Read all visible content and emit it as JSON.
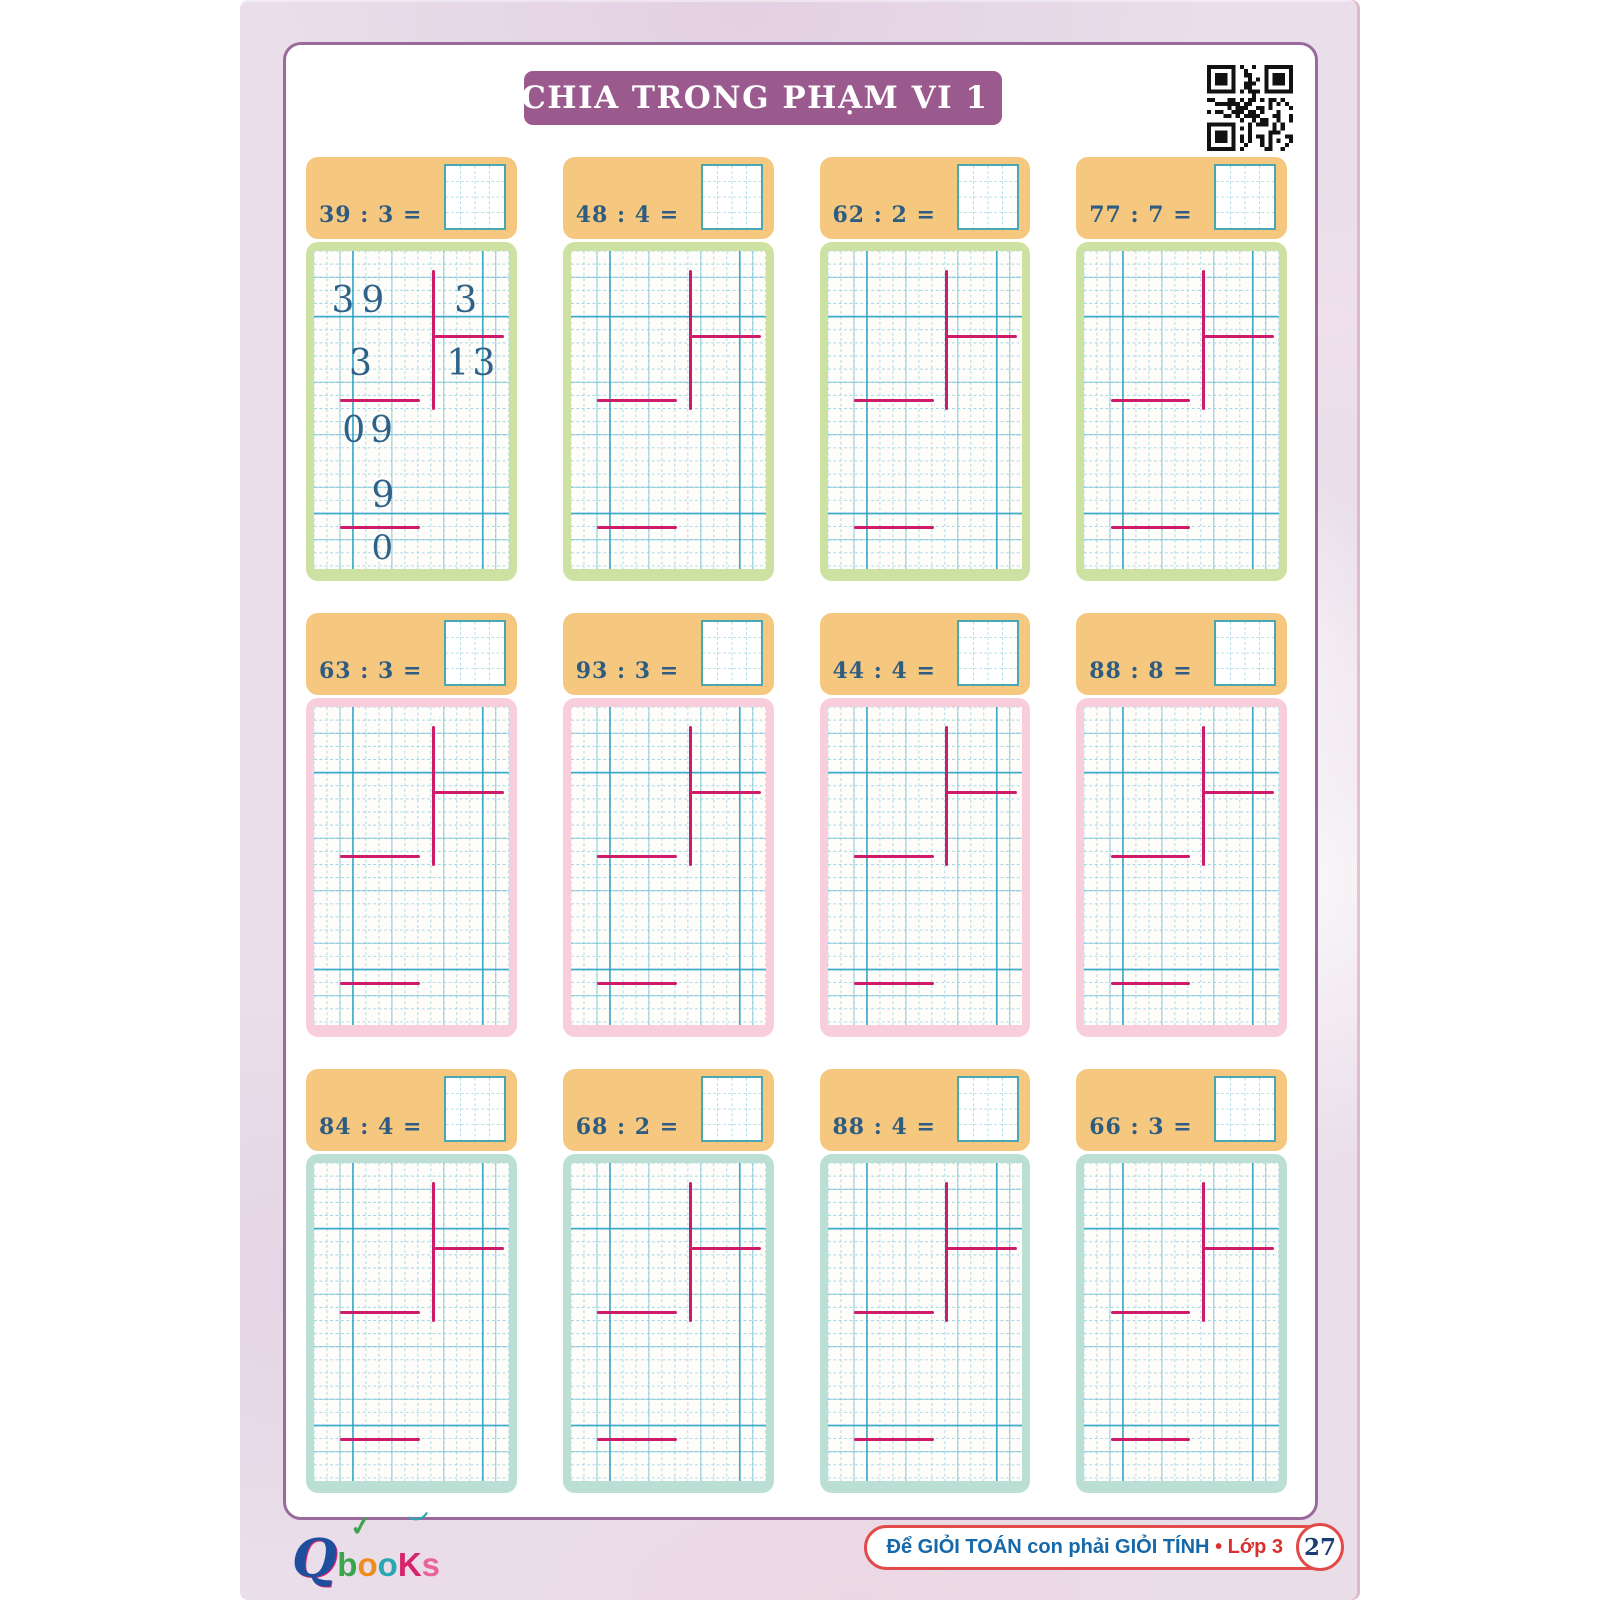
{
  "title": "BÉ CHIA TRONG PHẠM VI 1 000",
  "colors": {
    "title_bg": "#9a5a8e",
    "header_orange": "#f6c77f",
    "frame_green": "#cde2a2",
    "frame_pink": "#f8cedd",
    "frame_teal": "#bcdfd5",
    "grid_minor": "#9fd6e4",
    "grid_major": "#2ea3c6",
    "division_line": "#ce1b6a",
    "digit_blue": "#2f6288",
    "footer_red": "#e34b4b",
    "footer_blue": "#1668a8"
  },
  "cards": [
    {
      "problem": "39 : 3 =",
      "frame": "green",
      "worked": {
        "dividend": "39",
        "divisor": "3",
        "quotient": "13",
        "step1": "3",
        "step2": "09",
        "step3": "9",
        "step4": "0"
      }
    },
    {
      "problem": "48 : 4 =",
      "frame": "green"
    },
    {
      "problem": "62 : 2 =",
      "frame": "green"
    },
    {
      "problem": "77 : 7 =",
      "frame": "green"
    },
    {
      "problem": "63 : 3 =",
      "frame": "pink"
    },
    {
      "problem": "93 : 3 =",
      "frame": "pink"
    },
    {
      "problem": "44 : 4 =",
      "frame": "pink"
    },
    {
      "problem": "88 : 8 =",
      "frame": "pink"
    },
    {
      "problem": "84 : 4 =",
      "frame": "teal"
    },
    {
      "problem": "68 : 2 =",
      "frame": "teal"
    },
    {
      "problem": "88 : 4 =",
      "frame": "teal"
    },
    {
      "problem": "66 : 3 =",
      "frame": "teal"
    }
  ],
  "footer": {
    "slogan": "Để GIỎI TOÁN con phải GIỎI TÍNH",
    "bullet": "•",
    "grade": "Lớp 3",
    "page_number": "27"
  },
  "logo": {
    "q": "Q",
    "check": "✓",
    "bird": "︶",
    "letters": [
      {
        "ch": "b",
        "color": "#3aa54c"
      },
      {
        "ch": "o",
        "color": "#f08c1e"
      },
      {
        "ch": "o",
        "color": "#28a8b5"
      },
      {
        "ch": "K",
        "color": "#d6246e"
      },
      {
        "ch": "s",
        "color": "#e8639a"
      }
    ]
  }
}
